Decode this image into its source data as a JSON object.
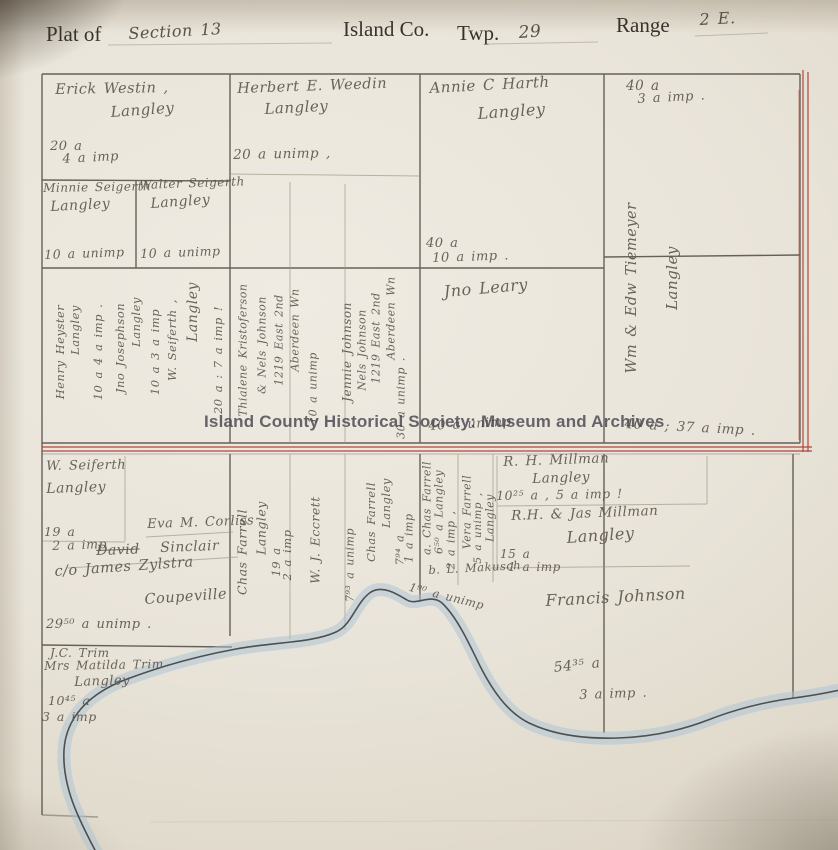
{
  "header": {
    "plat_of": "Plat of",
    "section": "Section 13",
    "county": "Island Co.",
    "twp_label": "Twp.",
    "twp_value": "29",
    "range_label": "Range",
    "range_value": "2 E."
  },
  "watermark": "Island County Historical Society: Museum and Archives",
  "colors": {
    "paper": "#e9e4d9",
    "ink_line": "#44403a",
    "red_boundary": "#b2473c",
    "pencil": "#7b7265",
    "water_blue": "#a9c2d3"
  },
  "labels": [
    {
      "name": "westin-name",
      "text": "Erick Westin ,",
      "x": 55,
      "y": 82,
      "size": 14.5,
      "rot": -1
    },
    {
      "name": "westin-city",
      "text": "Langley",
      "x": 110,
      "y": 103,
      "size": 15,
      "rot": -4
    },
    {
      "name": "westin-acres",
      "text": "20 a",
      "x": 50,
      "y": 139,
      "size": 13
    },
    {
      "name": "westin-imp",
      "text": "4 a imp",
      "x": 62,
      "y": 152,
      "size": 13,
      "rot": -3
    },
    {
      "name": "minnie-seigerth-name",
      "text": "Minnie Seigerth",
      "x": 43,
      "y": 181,
      "size": 12,
      "rot": -1
    },
    {
      "name": "minnie-seigerth-city",
      "text": "Langley",
      "x": 50,
      "y": 199,
      "size": 14,
      "rot": -3
    },
    {
      "name": "minnie-seigerth-acres",
      "text": "10 a unimp",
      "x": 44,
      "y": 247,
      "size": 12.5,
      "rot": -2
    },
    {
      "name": "walter-seigerth-name",
      "text": "Walter Seigerth",
      "x": 139,
      "y": 178,
      "size": 12,
      "rot": -2
    },
    {
      "name": "walter-seigerth-city",
      "text": "Langley",
      "x": 150,
      "y": 196,
      "size": 14,
      "rot": -4
    },
    {
      "name": "walter-seigerth-acres",
      "text": "10 a unimp",
      "x": 140,
      "y": 246,
      "size": 12.5,
      "rot": -2
    },
    {
      "name": "weedin-name",
      "text": "Herbert E. Weedin",
      "x": 237,
      "y": 81,
      "size": 14.5,
      "rot": -2
    },
    {
      "name": "weedin-city",
      "text": "Langley",
      "x": 264,
      "y": 100,
      "size": 15,
      "rot": -3
    },
    {
      "name": "weedin-acres",
      "text": "20 a unimp ,",
      "x": 233,
      "y": 147,
      "size": 13.5,
      "rot": -1
    },
    {
      "name": "harth-name",
      "text": "Annie C Harth",
      "x": 429,
      "y": 79,
      "size": 15,
      "rot": -3
    },
    {
      "name": "harth-city",
      "text": "Langley",
      "x": 477,
      "y": 104,
      "size": 16,
      "rot": -4
    },
    {
      "name": "harth-acres",
      "text": "40 a",
      "x": 426,
      "y": 236,
      "size": 13
    },
    {
      "name": "harth-imp",
      "text": "10 a imp .",
      "x": 432,
      "y": 251,
      "size": 13,
      "rot": -2
    },
    {
      "name": "tiemeyer-acres",
      "text": "40 a",
      "x": 626,
      "y": 78,
      "size": 13.5
    },
    {
      "name": "tiemeyer-imp",
      "text": "3 a imp .",
      "x": 637,
      "y": 92,
      "size": 13,
      "rot": -3
    },
    {
      "name": "tiemeyer-name",
      "text": "Wm & Edw Tiemeyer",
      "x": 632,
      "y": 288,
      "size": 14.5,
      "vert": true
    },
    {
      "name": "tiemeyer-city",
      "text": "Langley",
      "x": 672,
      "y": 278,
      "size": 15,
      "vert": true
    },
    {
      "name": "heyster-name",
      "text": "Henry Heyster",
      "x": 60,
      "y": 352,
      "size": 11.5,
      "vert": true
    },
    {
      "name": "heyster-city",
      "text": "Langley",
      "x": 75,
      "y": 330,
      "size": 11.5,
      "vert": true
    },
    {
      "name": "heyster-acres",
      "text": "10 a  4 a imp .",
      "x": 98,
      "y": 352,
      "size": 11.5,
      "vert": true
    },
    {
      "name": "josephson-name",
      "text": "Jno Josephson",
      "x": 120,
      "y": 348,
      "size": 11.5,
      "vert": true
    },
    {
      "name": "josephson-city",
      "text": "Langley",
      "x": 136,
      "y": 322,
      "size": 11.5,
      "vert": true
    },
    {
      "name": "josephson-acres",
      "text": "10 a  3 a imp",
      "x": 155,
      "y": 352,
      "size": 11.5,
      "vert": true
    },
    {
      "name": "w-seiferth-strip-name",
      "text": "W. Seiferth ,",
      "x": 172,
      "y": 340,
      "size": 11.5,
      "vert": true
    },
    {
      "name": "w-seiferth-strip-city",
      "text": "Langley",
      "x": 193,
      "y": 312,
      "size": 14,
      "vert": true
    },
    {
      "name": "w-seiferth-strip-acres",
      "text": "20 a :  7 a imp !",
      "x": 218,
      "y": 360,
      "size": 11.5,
      "vert": true
    },
    {
      "name": "kristoferson-name",
      "text": "Thialene Kristoferson",
      "x": 243,
      "y": 350,
      "size": 11,
      "vert": true
    },
    {
      "name": "kristoferson-name2",
      "text": "& Nels Johnson",
      "x": 262,
      "y": 345,
      "size": 11,
      "vert": true
    },
    {
      "name": "kristoferson-address",
      "text": "1219 East 2nd",
      "x": 279,
      "y": 340,
      "size": 11,
      "vert": true
    },
    {
      "name": "kristoferson-address2",
      "text": "Aberdeen Wn",
      "x": 295,
      "y": 330,
      "size": 11,
      "vert": true
    },
    {
      "name": "kristoferson-acres",
      "text": "10 a unimp",
      "x": 313,
      "y": 388,
      "size": 11,
      "vert": true
    },
    {
      "name": "jennie-johnson-name",
      "text": "Jennie Johnson",
      "x": 347,
      "y": 352,
      "size": 12,
      "vert": true
    },
    {
      "name": "jennie-johnson-name2",
      "text": "Nels Johnson",
      "x": 362,
      "y": 350,
      "size": 11,
      "vert": true
    },
    {
      "name": "jennie-johnson-address",
      "text": "1219 East 2nd",
      "x": 376,
      "y": 338,
      "size": 11,
      "vert": true
    },
    {
      "name": "jennie-johnson-address2",
      "text": "Aberdeen Wn",
      "x": 391,
      "y": 318,
      "size": 11,
      "vert": true
    },
    {
      "name": "jennie-johnson-acres",
      "text": "30 a unimp .",
      "x": 401,
      "y": 398,
      "size": 11,
      "vert": true
    },
    {
      "name": "leary-name",
      "text": "Jno Leary",
      "x": 443,
      "y": 282,
      "size": 16,
      "rot": -5
    },
    {
      "name": "leary-acres",
      "text": "40 a unimp",
      "x": 428,
      "y": 419,
      "size": 13,
      "rot": -3
    },
    {
      "name": "tiemeyer-acres-south",
      "text": "40 a ; 37 a imp .",
      "x": 625,
      "y": 416,
      "size": 13.5,
      "rot": 3
    },
    {
      "name": "w-seiferth-name",
      "text": "W. Seiferth",
      "x": 46,
      "y": 459,
      "size": 13,
      "rot": -1
    },
    {
      "name": "w-seiferth-city",
      "text": "Langley",
      "x": 46,
      "y": 481,
      "size": 14,
      "rot": -2
    },
    {
      "name": "w-seiferth-acres",
      "text": "19 a",
      "x": 44,
      "y": 524,
      "size": 12.5
    },
    {
      "name": "w-seiferth-imp",
      "text": "2 a imp",
      "x": 52,
      "y": 538,
      "size": 12.5,
      "rot": -2
    },
    {
      "name": "corliss-name",
      "text": "Eva M. Corliss",
      "x": 147,
      "y": 517,
      "size": 13,
      "rot": -2
    },
    {
      "name": "sinclair-first-name",
      "text": "David",
      "x": 96,
      "y": 543,
      "size": 14,
      "rot": -2,
      "strike": true
    },
    {
      "name": "sinclair-last-name",
      "text": "Sinclair",
      "x": 160,
      "y": 540,
      "size": 14,
      "rot": -2
    },
    {
      "name": "sinclair-care-of",
      "text": "c/o James Zylstra",
      "x": 54,
      "y": 564,
      "size": 14.5,
      "rot": -4
    },
    {
      "name": "sinclair-city",
      "text": "Coupeville",
      "x": 144,
      "y": 592,
      "size": 14.5,
      "rot": -4
    },
    {
      "name": "sinclair-acres",
      "text": "29⁵⁰ a unimp .",
      "x": 46,
      "y": 617,
      "size": 13
    },
    {
      "name": "trim-name",
      "text": "J.C. Trim",
      "x": 50,
      "y": 646,
      "size": 12
    },
    {
      "name": "trim-name2",
      "text": "Mrs Matilda Trim",
      "x": 44,
      "y": 659,
      "size": 12,
      "rot": -1
    },
    {
      "name": "trim-city",
      "text": "Langley",
      "x": 74,
      "y": 675,
      "size": 13,
      "rot": -2
    },
    {
      "name": "trim-acres",
      "text": "10⁴⁵ a",
      "x": 48,
      "y": 693,
      "size": 12.5
    },
    {
      "name": "trim-imp",
      "text": "3 a imp",
      "x": 42,
      "y": 709,
      "size": 12.5
    },
    {
      "name": "chas-farrell1-name",
      "text": "Chas Farrell",
      "x": 242,
      "y": 552,
      "size": 12.5,
      "vert": true
    },
    {
      "name": "chas-farrell1-city",
      "text": "Langley",
      "x": 261,
      "y": 528,
      "size": 12.5,
      "vert": true
    },
    {
      "name": "chas-farrell1-acres",
      "text": "19 a",
      "x": 276,
      "y": 562,
      "size": 11.5,
      "vert": true
    },
    {
      "name": "chas-farrell1-imp",
      "text": "2 a imp",
      "x": 287,
      "y": 555,
      "size": 11.5,
      "vert": true
    },
    {
      "name": "eccrett-name",
      "text": "W. J. Eccrett",
      "x": 315,
      "y": 540,
      "size": 12.5,
      "vert": true
    },
    {
      "name": "eccrett-acres",
      "text": "7⁹³ a unimp",
      "x": 350,
      "y": 565,
      "size": 11,
      "vert": true
    },
    {
      "name": "chas-farrell2-name",
      "text": "Chas Farrell",
      "x": 371,
      "y": 522,
      "size": 11.5,
      "vert": true
    },
    {
      "name": "chas-farrell2-city",
      "text": "Langley",
      "x": 386,
      "y": 503,
      "size": 11.5,
      "vert": true
    },
    {
      "name": "chas-farrell2-acres",
      "text": "7⁹⁴ a",
      "x": 400,
      "y": 550,
      "size": 11,
      "vert": true
    },
    {
      "name": "chas-farrell2-imp",
      "text": "1 a imp",
      "x": 409,
      "y": 538,
      "size": 11,
      "vert": true
    },
    {
      "name": "chas-farrell3-name",
      "text": "a. Chas Farrell",
      "x": 427,
      "y": 508,
      "size": 11,
      "vert": true
    },
    {
      "name": "chas-farrell3-acres",
      "text": "6⁵⁰ a Langley",
      "x": 439,
      "y": 512,
      "size": 11,
      "vert": true
    },
    {
      "name": "chas-farrell3-imp",
      "text": "2 a imp ,",
      "x": 451,
      "y": 540,
      "size": 11,
      "vert": true
    },
    {
      "name": "vera-farrell-name",
      "text": "Vera Farrell",
      "x": 467,
      "y": 512,
      "size": 11,
      "vert": true
    },
    {
      "name": "vera-farrell-acres",
      "text": "5 a unimp ,",
      "x": 478,
      "y": 528,
      "size": 10.5,
      "vert": true
    },
    {
      "name": "vera-farrell-city",
      "text": "Langley",
      "x": 490,
      "y": 518,
      "size": 11,
      "vert": true
    },
    {
      "name": "makusch-name",
      "text": "b. L. Makusch",
      "x": 428,
      "y": 563,
      "size": 11.5,
      "rot": -3
    },
    {
      "name": "makusch-acres",
      "text": "1⁹⁰ a unimp",
      "x": 411,
      "y": 580,
      "size": 11.5,
      "rot": 14
    },
    {
      "name": "millman1-name",
      "text": "R. H. Millman",
      "x": 503,
      "y": 454,
      "size": 13.5,
      "rot": -2
    },
    {
      "name": "millman1-city",
      "text": "Langley",
      "x": 532,
      "y": 471,
      "size": 13.5,
      "rot": -2
    },
    {
      "name": "millman1-acres",
      "text": "10²⁵ a , 5 a imp !",
      "x": 496,
      "y": 488,
      "size": 12.5,
      "rot": -1
    },
    {
      "name": "millman2-name",
      "text": "R.H. & Jas Millman",
      "x": 511,
      "y": 508,
      "size": 13.5,
      "rot": -2
    },
    {
      "name": "millman2-city",
      "text": "Langley",
      "x": 566,
      "y": 528,
      "size": 16,
      "rot": -4
    },
    {
      "name": "millman2-acres",
      "text": "15 a",
      "x": 500,
      "y": 547,
      "size": 12
    },
    {
      "name": "millman2-imp",
      "text": "1 a imp",
      "x": 508,
      "y": 560,
      "size": 12
    },
    {
      "name": "francis-johnson-name",
      "text": "Francis Johnson",
      "x": 545,
      "y": 591,
      "size": 16,
      "rot": -3
    },
    {
      "name": "francis-johnson-acres",
      "text": "54³⁵ a",
      "x": 553,
      "y": 660,
      "size": 14,
      "rot": -6
    },
    {
      "name": "francis-johnson-imp",
      "text": "3 a imp .",
      "x": 579,
      "y": 688,
      "size": 13,
      "rot": -2
    }
  ]
}
